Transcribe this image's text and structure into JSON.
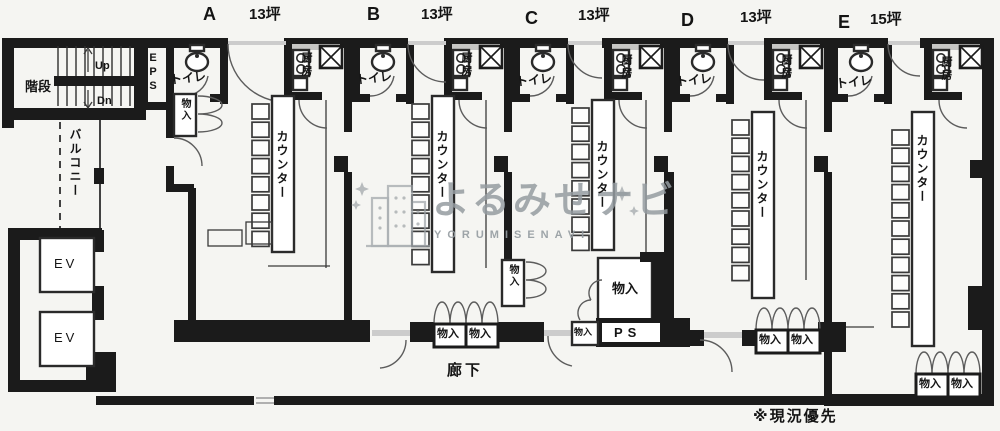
{
  "units": [
    {
      "name": "A",
      "area": "13坪"
    },
    {
      "name": "B",
      "area": "13坪"
    },
    {
      "name": "C",
      "area": "13坪"
    },
    {
      "name": "D",
      "area": "13坪"
    },
    {
      "name": "E",
      "area": "15坪"
    }
  ],
  "labels": {
    "toilet": "トイレ",
    "kitchen": "厨房",
    "counter": "カウンター",
    "storage": "物入",
    "corridor": "廊下",
    "stairs": "階段",
    "up": "Up",
    "dn": "Dn",
    "eps": "EPS",
    "balcony": "バルコニー",
    "elevator": "EV",
    "ps": "PS",
    "note": "※現況優先"
  },
  "watermark": {
    "title": "よるみせナビ",
    "subtitle": "YORUMISENAVI"
  },
  "colors": {
    "wall": "#1b1b1b",
    "paper": "#f5f5f2",
    "watermark": "#9aa0a4"
  }
}
